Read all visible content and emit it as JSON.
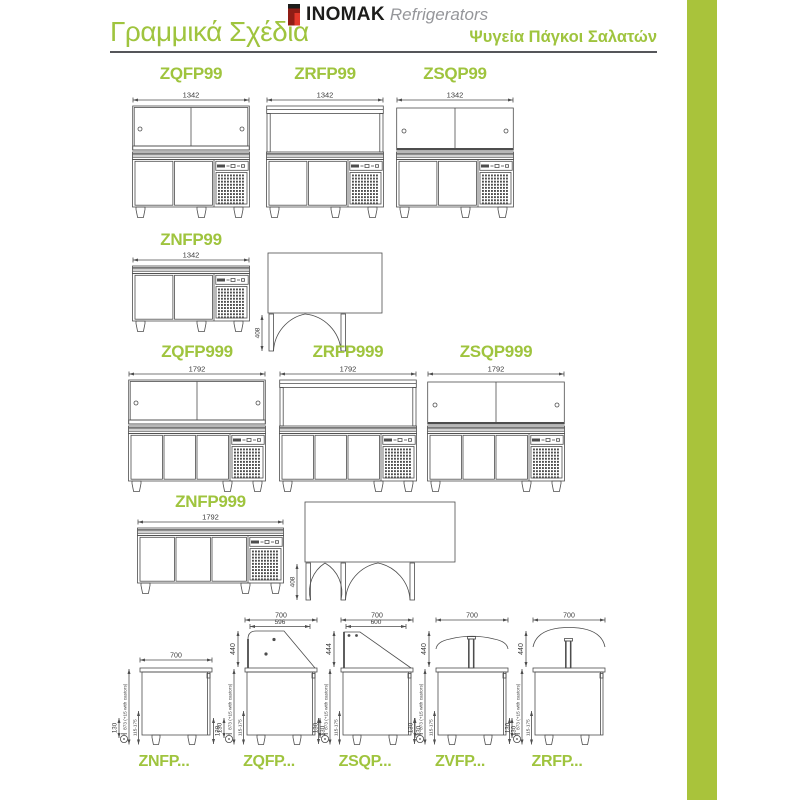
{
  "header": {
    "title_left": "Γραμμικά Σχέδια",
    "brand": "INOMAK",
    "brand_suffix": "Refrigerators",
    "title_right": "Ψυγεία Πάγκοι Σαλατών"
  },
  "colors": {
    "accent_green": "#9fc43e",
    "bar_green": "#a9c33b",
    "line_dark": "#4d4d4d"
  },
  "drawings": {
    "front": [
      {
        "model": "ZQFP99",
        "dim": "1342",
        "doors": 2,
        "top": "sliding"
      },
      {
        "model": "ZRFP99",
        "dim": "1342",
        "doors": 2,
        "top": "frame"
      },
      {
        "model": "ZSQP99",
        "dim": "1342",
        "doors": 2,
        "top": "sliding2"
      },
      {
        "model": "ZNFP99",
        "dim": "1342",
        "doors": 2,
        "top": "none"
      },
      {
        "model": "ZQFP999",
        "dim": "1792",
        "doors": 3,
        "top": "sliding"
      },
      {
        "model": "ZRFP999",
        "dim": "1792",
        "doors": 3,
        "top": "frame"
      },
      {
        "model": "ZSQP999",
        "dim": "1792",
        "doors": 3,
        "top": "sliding2"
      },
      {
        "model": "ZNFP999",
        "dim": "1792",
        "doors": 3,
        "top": "none"
      }
    ],
    "plan": [
      {
        "depth": "408",
        "doors": 2
      },
      {
        "depth": "408",
        "doors": 3
      }
    ],
    "side": [
      {
        "model": "ZNFP...",
        "top": "none",
        "dims": {
          "width": "700",
          "height": "873 (+15 with castors)",
          "feet_range": "115-175",
          "left_foot": "130",
          "right_foot": "130"
        }
      },
      {
        "model": "ZQFP...",
        "top": "curve",
        "dims": {
          "width": "700",
          "inner": "596",
          "top_height": "440",
          "height": "873 (+15 with castors)",
          "feet_range": "115-175",
          "left_foot": "130",
          "right_foot": "130"
        }
      },
      {
        "model": "ZSQP...",
        "top": "slant",
        "dims": {
          "width": "700",
          "inner": "600",
          "top_height": "444",
          "height": "873 (+15 with castors)",
          "feet_range": "115-175",
          "left_foot": "130",
          "right_foot": "130"
        }
      },
      {
        "model": "ZVFP...",
        "top": "post",
        "dims": {
          "width": "700",
          "top_height": "440",
          "height": "873 (+15 with castors)",
          "feet_range": "115-175",
          "left_foot": "130",
          "right_foot": "130"
        }
      },
      {
        "model": "ZRFP...",
        "top": "dome",
        "dims": {
          "width": "700",
          "top_height": "440",
          "height": "873 (+15 with castors)",
          "feet_range": "115-175",
          "left_foot": "130"
        }
      }
    ]
  }
}
